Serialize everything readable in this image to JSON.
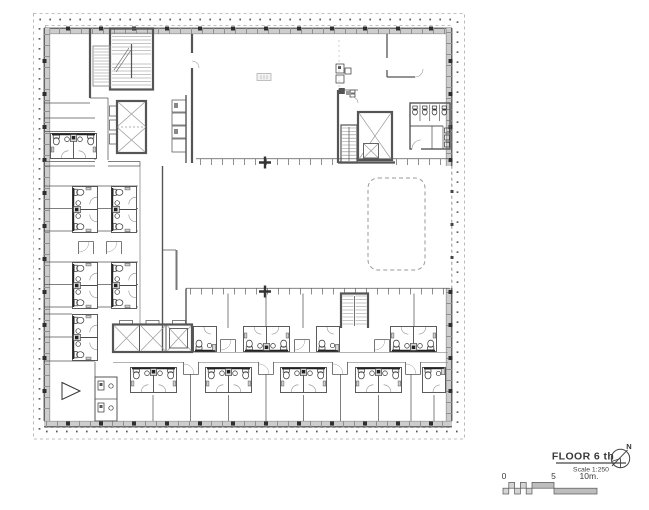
{
  "title_block": {
    "title": "FLOOR 6 th",
    "scale_label": "Scale 1:250"
  },
  "north_arrow": {
    "label": "N"
  },
  "scale_bar": {
    "zero": "0",
    "five": "5",
    "ten": "10m."
  },
  "colors": {
    "background": "#ffffff",
    "wall_gray": "#cdcdcd",
    "line_dark": "#3a3a3a",
    "line_medium": "#666666",
    "line_light": "#999999",
    "dashed_grid": "#aaaaaa"
  }
}
